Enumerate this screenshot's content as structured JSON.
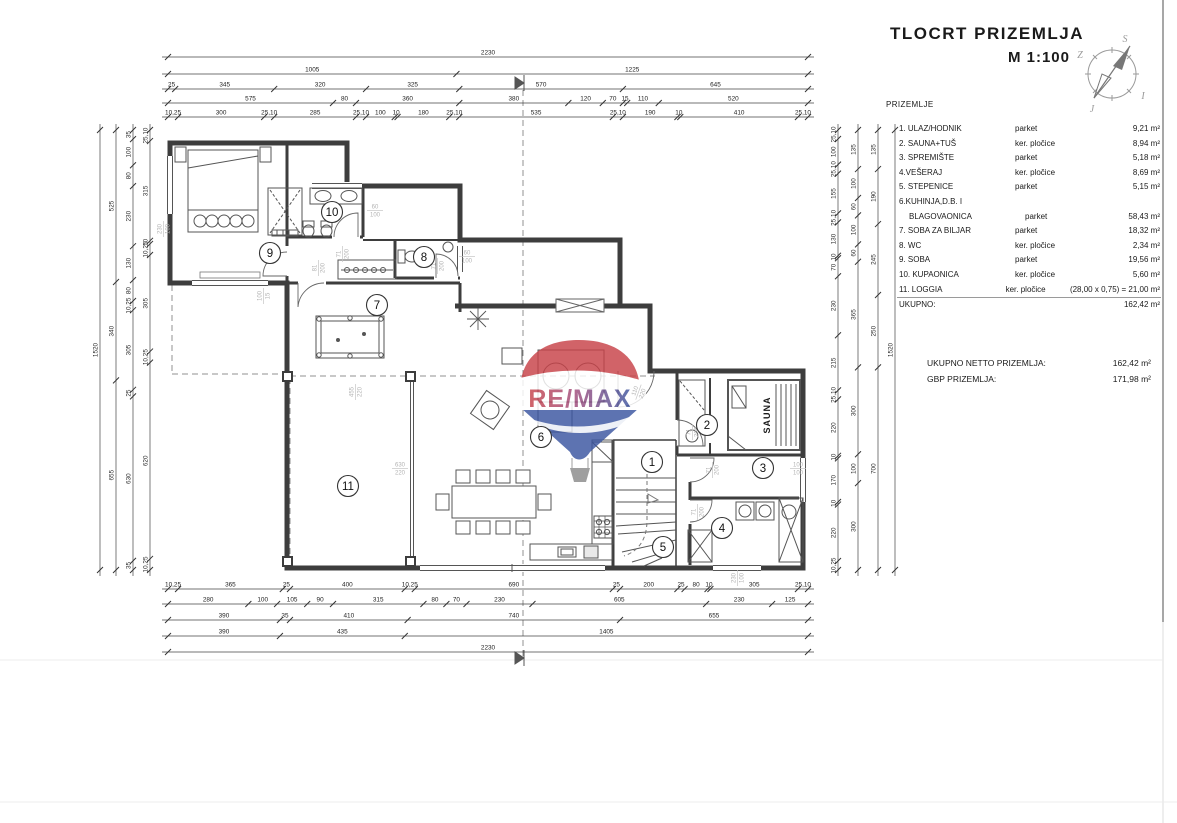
{
  "title_block": {
    "title": "TLOCRT  PRIZEMLJA",
    "scale": "M 1:100",
    "section_label": "PRIZEMLJE"
  },
  "compass": {
    "top": "S",
    "left": "Z",
    "right": "I",
    "bottom": "J"
  },
  "watermark": {
    "text": "RE/MAX",
    "red": "#c74248",
    "blue": "#3a55a0"
  },
  "rooms_table": {
    "rows": [
      {
        "name": "1. ULAZ/HODNIK",
        "indent": false,
        "material": "parket",
        "area": "9,21 m²"
      },
      {
        "name": "2. SAUNA+TUŠ",
        "indent": false,
        "material": "ker. pločice",
        "area": "8,94 m²"
      },
      {
        "name": "3. SPREMIŠTE",
        "indent": false,
        "material": "parket",
        "area": "5,18 m²"
      },
      {
        "name": "4.VEŠERAJ",
        "indent": false,
        "material": "ker. pločice",
        "area": "8,69 m²"
      },
      {
        "name": "5. STEPENICE",
        "indent": false,
        "material": "parket",
        "area": "5,15 m²"
      },
      {
        "name": "6.KUHINJA,D.B. I",
        "indent": false,
        "material": "",
        "area": ""
      },
      {
        "name": "BLAGOVAONICA",
        "indent": true,
        "material": "parket",
        "area": "58,43 m²"
      },
      {
        "name": "7. SOBA ZA BILJAR",
        "indent": false,
        "material": "parket",
        "area": "18,32 m²"
      },
      {
        "name": "8. WC",
        "indent": false,
        "material": "ker. pločice",
        "area": "2,34 m²"
      },
      {
        "name": "9. SOBA",
        "indent": false,
        "material": "parket",
        "area": "19,56 m²"
      },
      {
        "name": "10. KUPAONICA",
        "indent": false,
        "material": "ker. pločice",
        "area": "5,60 m²"
      },
      {
        "name": "11. LOGGIA",
        "indent": false,
        "material": "ker. pločice",
        "area": "(28,00 x 0,75) = 21,00 m²"
      }
    ],
    "total_label": "UKUPNO:",
    "total_value": "162,42 m²"
  },
  "totals": {
    "net_label": "UKUPNO NETTO PRIZEMLJA:",
    "net_value": "162,42 m²",
    "gbp_label": "GBP PRIZEMLJA:",
    "gbp_value": "171,98 m²"
  },
  "plan": {
    "sauna_label": "SAUNA",
    "room_markers": [
      {
        "n": "1",
        "x": 652,
        "y": 462
      },
      {
        "n": "2",
        "x": 707,
        "y": 425
      },
      {
        "n": "3",
        "x": 763,
        "y": 468
      },
      {
        "n": "4",
        "x": 722,
        "y": 528
      },
      {
        "n": "5",
        "x": 663,
        "y": 547
      },
      {
        "n": "6",
        "x": 541,
        "y": 437
      },
      {
        "n": "7",
        "x": 377,
        "y": 305
      },
      {
        "n": "8",
        "x": 424,
        "y": 257
      },
      {
        "n": "9",
        "x": 270,
        "y": 253
      },
      {
        "n": "10",
        "x": 332,
        "y": 212
      },
      {
        "n": "11",
        "x": 348,
        "y": 486
      }
    ],
    "opening_labels": [
      {
        "x": 163,
        "y": 229,
        "rot": -90,
        "w": "230",
        "h": "100"
      },
      {
        "x": 375,
        "y": 210,
        "rot": 0,
        "w": "60",
        "h": "100"
      },
      {
        "x": 467,
        "y": 256,
        "rot": 0,
        "w": "60",
        "h": "100"
      },
      {
        "x": 342,
        "y": 254,
        "rot": -90,
        "w": "71",
        "h": "200"
      },
      {
        "x": 318,
        "y": 268,
        "rot": -90,
        "w": "81",
        "h": "200"
      },
      {
        "x": 437,
        "y": 266,
        "rot": -90,
        "w": "71",
        "h": "200"
      },
      {
        "x": 638,
        "y": 392,
        "rot": -70,
        "w": "110",
        "h": "220"
      },
      {
        "x": 692,
        "y": 432,
        "rot": -90,
        "w": "71",
        "h": "200"
      },
      {
        "x": 712,
        "y": 470,
        "rot": -90,
        "w": "71",
        "h": "200"
      },
      {
        "x": 697,
        "y": 512,
        "rot": -90,
        "w": "71",
        "h": "200"
      },
      {
        "x": 798,
        "y": 468,
        "rot": 0,
        "w": "100",
        "h": "100"
      },
      {
        "x": 355,
        "y": 392,
        "rot": -90,
        "w": "455",
        "h": "220"
      },
      {
        "x": 400,
        "y": 468,
        "rot": 0,
        "w": "630",
        "h": "220"
      },
      {
        "x": 737,
        "y": 578,
        "rot": -90,
        "w": "230",
        "h": "100"
      },
      {
        "x": 263,
        "y": 296,
        "rot": -90,
        "w": "100",
        "h": "15"
      }
    ],
    "dim_chains": [
      {
        "axis": "h",
        "pos": 57,
        "from": 168,
        "to": 808,
        "values": [
          "2230"
        ]
      },
      {
        "axis": "h",
        "pos": 74,
        "from": 168,
        "to": 808,
        "values": [
          "1005",
          "1225"
        ]
      },
      {
        "axis": "h",
        "pos": 89,
        "from": 168,
        "to": 808,
        "values": [
          "25",
          "345",
          "320",
          "325",
          "570",
          "645"
        ]
      },
      {
        "axis": "h",
        "pos": 103,
        "from": 168,
        "to": 808,
        "values": [
          "575",
          "80",
          "360",
          "380",
          "120",
          "70",
          "15",
          "110",
          "520"
        ]
      },
      {
        "axis": "h",
        "pos": 117,
        "from": 168,
        "to": 808,
        "values": [
          "10,25",
          "300",
          "25,10",
          "285",
          "25,10",
          "100",
          "10",
          "180",
          "25,10",
          "535",
          "25,10",
          "190",
          "10",
          "410",
          "25,10"
        ]
      },
      {
        "axis": "h",
        "pos": 589,
        "from": 168,
        "to": 808,
        "values": [
          "10,25",
          "365",
          "25",
          "400",
          "10,25",
          "690",
          "25",
          "200",
          "25",
          "80",
          "10",
          "305",
          "25,10"
        ]
      },
      {
        "axis": "h",
        "pos": 604,
        "from": 168,
        "to": 808,
        "values": [
          "280",
          "100",
          "105",
          "90",
          "315",
          "80",
          "70",
          "230",
          "605",
          "230",
          "125"
        ]
      },
      {
        "axis": "h",
        "pos": 620,
        "from": 168,
        "to": 808,
        "values": [
          "390",
          "35",
          "410",
          "740",
          "655"
        ]
      },
      {
        "axis": "h",
        "pos": 636,
        "from": 168,
        "to": 808,
        "values": [
          "390",
          "435",
          "1405"
        ]
      },
      {
        "axis": "h",
        "pos": 652,
        "from": 168,
        "to": 808,
        "values": [
          "2230"
        ]
      },
      {
        "axis": "v",
        "pos": 100,
        "from": 130,
        "to": 570,
        "values": [
          "1520"
        ]
      },
      {
        "axis": "v",
        "pos": 116,
        "from": 130,
        "to": 570,
        "values": [
          "525",
          "340",
          "655"
        ]
      },
      {
        "axis": "v",
        "pos": 133,
        "from": 130,
        "to": 570,
        "values": [
          "35",
          "100",
          "80",
          "230",
          "130",
          "80",
          "10,25",
          "305",
          "25",
          "630",
          "35"
        ]
      },
      {
        "axis": "v",
        "pos": 150,
        "from": 130,
        "to": 570,
        "values": [
          "25,10",
          "315",
          "10",
          "10,25",
          "305",
          "10,25",
          "620",
          "10,25"
        ]
      },
      {
        "axis": "v",
        "pos": 838,
        "from": 130,
        "to": 570,
        "values": [
          "25,10",
          "100",
          "25,10",
          "155",
          "25,10",
          "130",
          "10",
          "70",
          "230",
          "215",
          "25,10",
          "220",
          "10",
          "170",
          "10",
          "220",
          "10,25"
        ]
      },
      {
        "axis": "v",
        "pos": 858,
        "from": 130,
        "to": 570,
        "values": [
          "135",
          "100",
          "60",
          "100",
          "60",
          "365",
          "300",
          "100",
          "300"
        ]
      },
      {
        "axis": "v",
        "pos": 878,
        "from": 130,
        "to": 570,
        "values": [
          "135",
          "190",
          "245",
          "250",
          "700"
        ]
      },
      {
        "axis": "v",
        "pos": 895,
        "from": 130,
        "to": 570,
        "values": [
          "1520"
        ]
      }
    ]
  }
}
